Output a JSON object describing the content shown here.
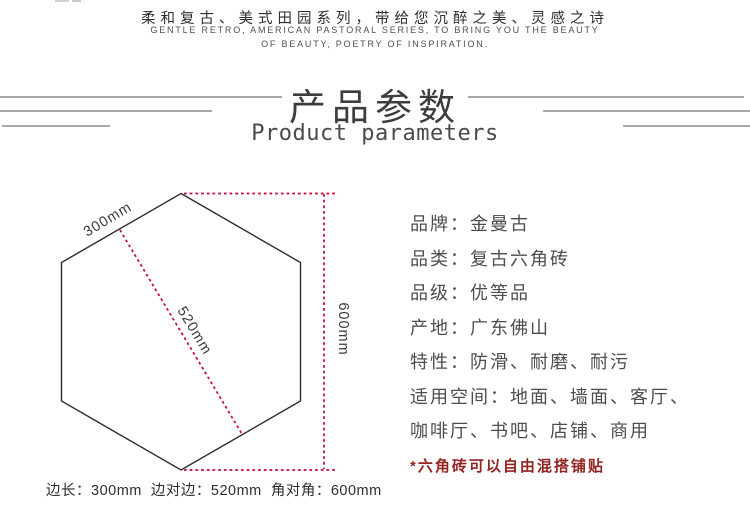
{
  "header": {
    "tagline_cn": "柔和复古、美式田园系列，带给您沉醉之美、灵感之诗",
    "tagline_en_line1": "GENTLE RETRO, AMERICAN PASTORAL SERIES, TO BRING YOU THE BEAUTY",
    "tagline_en_line2": "OF BEAUTY, POETRY OF INSPIRATION."
  },
  "section_title": {
    "cn": "产品参数",
    "en": "Product parameters"
  },
  "diagram": {
    "side_length_label": "300mm",
    "edge_to_edge_label": "520mm",
    "corner_to_corner_label": "600mm",
    "caption": "边长：300mm  边对边：520mm  角对角：600mm",
    "accent_color": "#cc0033",
    "outline_color": "#2d2d2d"
  },
  "specs": {
    "lines": [
      "品牌：金曼古",
      "品类：复古六角砖",
      "品级：优等品",
      "产地：广东佛山",
      "特性：防滑、耐磨、耐污",
      "适用空间：地面、墙面、客厅、",
      "咖啡厅、书吧、店铺、商用"
    ],
    "note": "*六角砖可以自由混搭铺贴",
    "note_color": "#942323"
  }
}
